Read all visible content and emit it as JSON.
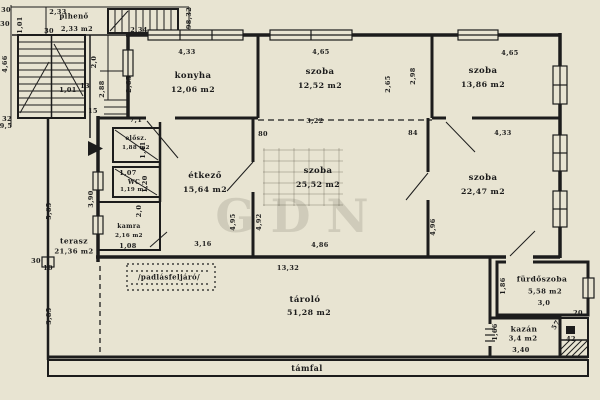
{
  "colors": {
    "paper": "#e8e4d2",
    "ink": "#1c1c1c",
    "watermark": "rgba(60,55,40,0.14)"
  },
  "watermark": {
    "text": "GDN"
  },
  "annotations": {
    "attic_access": "/padlásfeljáró/",
    "retaining_wall": "támfal"
  },
  "rooms": [
    {
      "id": "piheno",
      "name": "pihenő",
      "area": "2,33 m2",
      "nx": 74,
      "ny": 16,
      "ax": 77,
      "ay": 29,
      "fs": 7
    },
    {
      "id": "konyha",
      "name": "konyha",
      "area": "12,06 m2",
      "nx": 193,
      "ny": 76,
      "ax": 193,
      "ay": 90,
      "fs": 8.5
    },
    {
      "id": "szoba-1",
      "name": "szoba",
      "area": "12,52 m2",
      "nx": 320,
      "ny": 72,
      "ax": 320,
      "ay": 86,
      "fs": 8.5
    },
    {
      "id": "szoba-2",
      "name": "szoba",
      "area": "13,86 m2",
      "nx": 483,
      "ny": 71,
      "ax": 483,
      "ay": 85,
      "fs": 8.5
    },
    {
      "id": "elosz",
      "name": "elősz.",
      "area": "1,88 m2",
      "nx": 136,
      "ny": 139,
      "ax": 136,
      "ay": 149,
      "fs": 6
    },
    {
      "id": "wc",
      "name": "WC",
      "area": "1,19 m2",
      "nx": 134,
      "ny": 183,
      "ax": 134,
      "ay": 191,
      "fs": 6
    },
    {
      "id": "etkezo",
      "name": "étkező",
      "area": "15,64 m2",
      "nx": 205,
      "ny": 176,
      "ax": 205,
      "ay": 190,
      "fs": 8.5
    },
    {
      "id": "kamra",
      "name": "kamra",
      "area": "2,16 m2",
      "nx": 129,
      "ny": 227,
      "ax": 129,
      "ay": 237,
      "fs": 6
    },
    {
      "id": "szoba-3",
      "name": "szoba",
      "area": "25,52 m2",
      "nx": 318,
      "ny": 171,
      "ax": 318,
      "ay": 185,
      "fs": 8.5
    },
    {
      "id": "szoba-4",
      "name": "szoba",
      "area": "22,47 m2",
      "nx": 483,
      "ny": 178,
      "ax": 483,
      "ay": 192,
      "fs": 8.5
    },
    {
      "id": "terasz",
      "name": "terasz",
      "area": "21,36 m2",
      "nx": 74,
      "ny": 241,
      "ax": 74,
      "ay": 252,
      "fs": 7.5
    },
    {
      "id": "tarolo",
      "name": "tároló",
      "area": "51,28 m2",
      "nx": 305,
      "ny": 300,
      "ax": 309,
      "ay": 313,
      "fs": 8.5
    },
    {
      "id": "furdoszoba",
      "name": "fürdőszoba",
      "area": "5,58 m2",
      "nx": 542,
      "ny": 279,
      "ax": 545,
      "ay": 292,
      "fs": 7.5
    },
    {
      "id": "kazan",
      "name": "kazán",
      "area": "3,4 m2",
      "nx": 524,
      "ny": 329,
      "ax": 523,
      "ay": 339,
      "fs": 7.5
    }
  ],
  "dims": [
    {
      "t": "30",
      "x": 6,
      "y": 10
    },
    {
      "t": "30",
      "x": 5,
      "y": 24
    },
    {
      "t": "1,01",
      "x": 20,
      "y": 25,
      "r": -90
    },
    {
      "t": "4,66",
      "x": 5,
      "y": 64,
      "r": -90
    },
    {
      "t": "2,33",
      "x": 58,
      "y": 12
    },
    {
      "t": "30",
      "x": 49,
      "y": 31
    },
    {
      "t": "2,34",
      "x": 139,
      "y": 30
    },
    {
      "t": "98,32",
      "x": 189,
      "y": 18,
      "r": -90
    },
    {
      "t": "2,0",
      "x": 94,
      "y": 62,
      "r": -90
    },
    {
      "t": "2,88",
      "x": 102,
      "y": 89,
      "r": -90
    },
    {
      "t": "15",
      "x": 93,
      "y": 111
    },
    {
      "t": "1,01",
      "x": 68,
      "y": 90
    },
    {
      "t": "13",
      "x": 85,
      "y": 86
    },
    {
      "t": "32",
      "x": 7,
      "y": 119
    },
    {
      "t": "9,5",
      "x": 6,
      "y": 126
    },
    {
      "t": "2,65",
      "x": 129,
      "y": 84,
      "r": -90
    },
    {
      "t": "4,33",
      "x": 187,
      "y": 52
    },
    {
      "t": "4,65",
      "x": 321,
      "y": 52
    },
    {
      "t": "2,65",
      "x": 388,
      "y": 84,
      "r": -90
    },
    {
      "t": "2,98",
      "x": 413,
      "y": 76,
      "r": -90
    },
    {
      "t": "4,65",
      "x": 510,
      "y": 53
    },
    {
      "t": "7,1",
      "x": 136,
      "y": 120
    },
    {
      "t": "1,41",
      "x": 143,
      "y": 150,
      "r": -90
    },
    {
      "t": "1,07",
      "x": 128,
      "y": 173
    },
    {
      "t": "1,20",
      "x": 145,
      "y": 184,
      "r": -90
    },
    {
      "t": "3,90",
      "x": 91,
      "y": 199,
      "r": -90
    },
    {
      "t": "2,0",
      "x": 139,
      "y": 211,
      "r": -90
    },
    {
      "t": "1,08",
      "x": 128,
      "y": 246
    },
    {
      "t": "3,16",
      "x": 203,
      "y": 244
    },
    {
      "t": "4,95",
      "x": 233,
      "y": 222,
      "r": -90
    },
    {
      "t": "80",
      "x": 263,
      "y": 134
    },
    {
      "t": "3,22",
      "x": 315,
      "y": 121
    },
    {
      "t": "84",
      "x": 413,
      "y": 133
    },
    {
      "t": "4,92",
      "x": 259,
      "y": 222,
      "r": -90
    },
    {
      "t": "4,86",
      "x": 320,
      "y": 245
    },
    {
      "t": "4,33",
      "x": 503,
      "y": 133
    },
    {
      "t": "4,96",
      "x": 433,
      "y": 227,
      "r": -90
    },
    {
      "t": "5,65",
      "x": 49,
      "y": 211,
      "r": -90
    },
    {
      "t": "30",
      "x": 36,
      "y": 261
    },
    {
      "t": "10",
      "x": 48,
      "y": 268
    },
    {
      "t": "3,85",
      "x": 49,
      "y": 316,
      "r": -90
    },
    {
      "t": "13,32",
      "x": 288,
      "y": 268
    },
    {
      "t": "1,86",
      "x": 503,
      "y": 286,
      "r": -90
    },
    {
      "t": "3,0",
      "x": 544,
      "y": 303
    },
    {
      "t": "1,66",
      "x": 495,
      "y": 332,
      "r": -90
    },
    {
      "t": "3,40",
      "x": 521,
      "y": 350
    },
    {
      "t": "20",
      "x": 578,
      "y": 313
    },
    {
      "t": "57",
      "x": 556,
      "y": 325,
      "r": -60
    },
    {
      "t": "42",
      "x": 571,
      "y": 339
    }
  ]
}
